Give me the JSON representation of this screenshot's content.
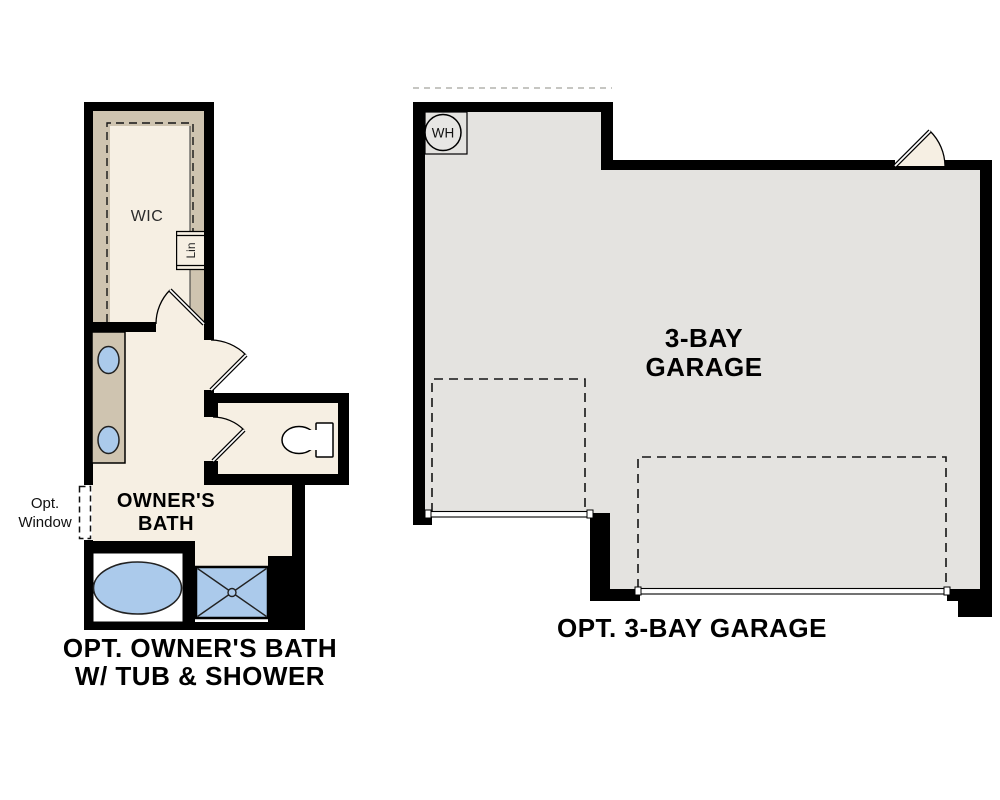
{
  "bath_plan": {
    "labels": {
      "wic": "WIC",
      "linen": "Lin",
      "opt_window_line1": "Opt.",
      "opt_window_line2": "Window",
      "room_name_line1": "OWNER'S",
      "room_name_line2": "BATH"
    },
    "caption_line1": "OPT. OWNER'S BATH",
    "caption_line2": "W/ TUB & SHOWER"
  },
  "garage_plan": {
    "labels": {
      "water_heater": "WH",
      "room_name_line1": "3-BAY",
      "room_name_line2": "GARAGE"
    },
    "caption": "OPT. 3-BAY GARAGE"
  },
  "colors": {
    "floor_cream": "#f6efe3",
    "wall_tan": "#cfc4b0",
    "floor_gray": "#e4e3e0",
    "fixture_blue": "#abcaeb",
    "wall_black": "#000000"
  }
}
